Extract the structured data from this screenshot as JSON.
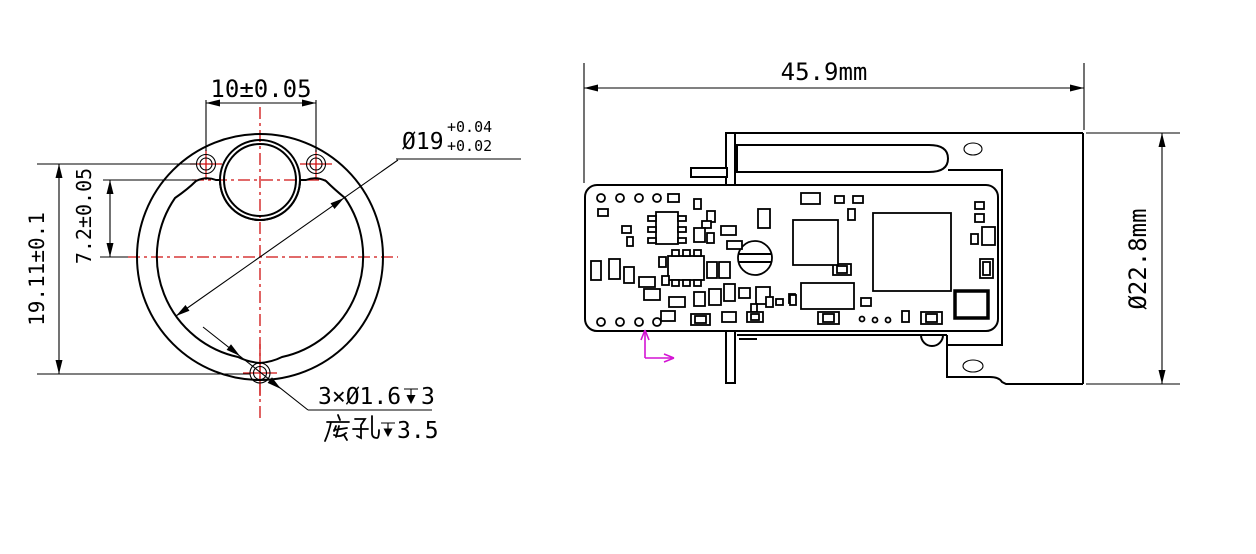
{
  "drawing": {
    "type": "engineering-drawing",
    "views": [
      "front-circular-view",
      "side-assembly-view"
    ]
  },
  "front_view": {
    "dim_hole_spacing": "10±0.05",
    "dim_total_height": "19.11±0.1",
    "dim_lens_offset": "7.2±0.05",
    "bore_diameter": "Ø19",
    "bore_tol_upper": "+0.04",
    "bore_tol_lower": "+0.02",
    "bore_callout_full": "Ø19 +0.04/+0.02",
    "hole_callout_prefix": "3×Ø1.6",
    "hole_callout_depth": "3",
    "hole_callout_full": "3×Ø1.6↧3",
    "base_hole_label": "底孔",
    "base_hole_depth": "3.5",
    "base_hole_full": "底孔↧3.5"
  },
  "side_view": {
    "dim_width": "45.9mm",
    "dim_height": "Ø22.8mm"
  },
  "colors": {
    "outline": "#000000",
    "centerline": "#cf1010",
    "datum_axis": "#d414d4",
    "background": "#ffffff"
  }
}
